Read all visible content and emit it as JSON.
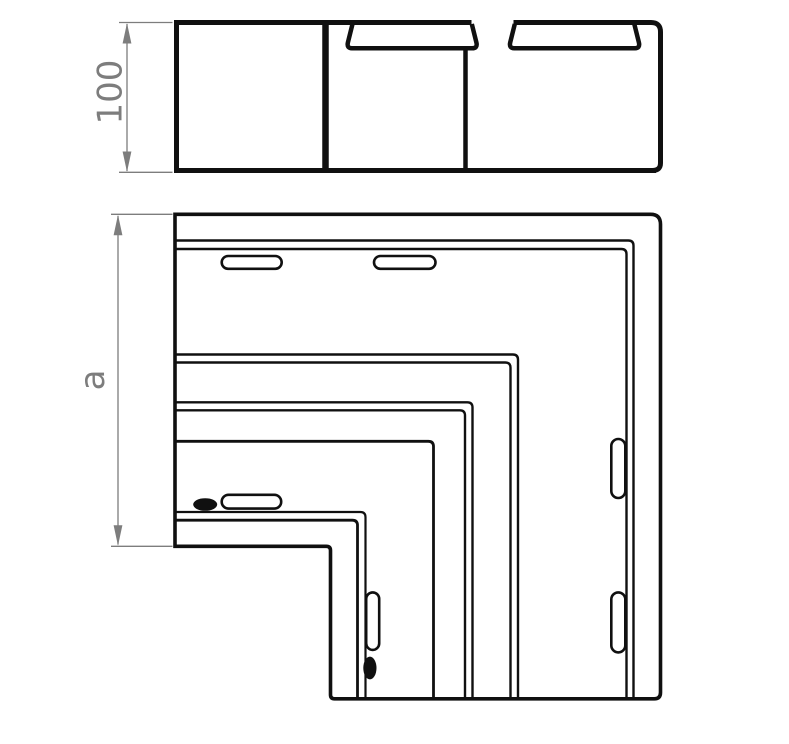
{
  "drawing": {
    "background": "#ffffff",
    "line_color": "#101010",
    "dimension_color": "#7d7d7d",
    "dimensions": {
      "height": {
        "label": "100"
      },
      "side": {
        "label": "a"
      }
    }
  }
}
